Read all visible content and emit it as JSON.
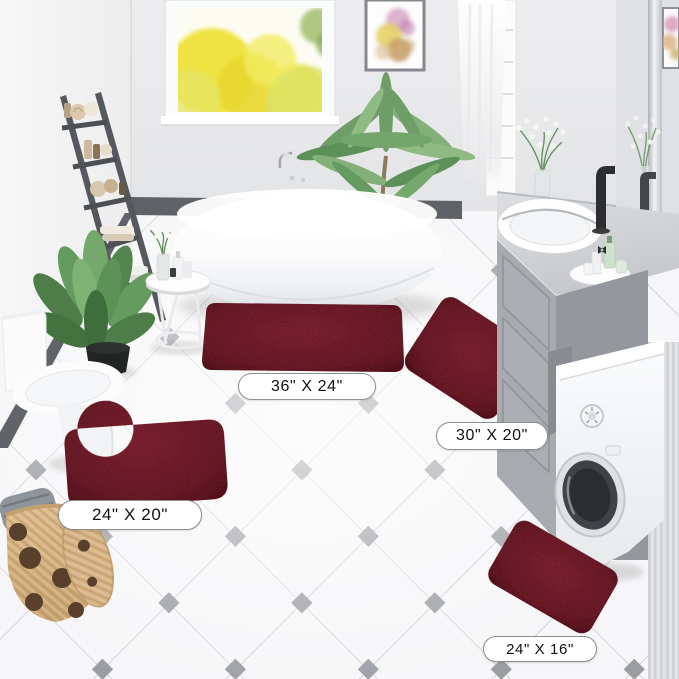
{
  "scene": "bathroom product photo - 4 piece burgundy chenille bath rug set",
  "rug_labels": [
    {
      "name": "rectangle-large",
      "text": "36\" X 24\""
    },
    {
      "name": "rectangle-medium",
      "text": "30\" X 20\""
    },
    {
      "name": "contour",
      "text": "24\" X 20\""
    },
    {
      "name": "rectangle-small",
      "text": "24\" X 16\""
    }
  ],
  "colors": {
    "rug": "#74202e",
    "rug_highlight": "#8a2838",
    "rug_shadow": "#5a1622",
    "label_bg": "#ffffff",
    "label_border": "#8e8e8e",
    "label_text": "#111111"
  },
  "objects": [
    "window-with-yellow-trees",
    "framed-flower-art",
    "sheer-curtain",
    "ladder-shelf-with-towels",
    "freestanding-bathtub",
    "chrome-tub-faucet",
    "palm-plant",
    "leafy-floor-plant",
    "side-table-with-toiletries",
    "toilet",
    "wicker-basket-with-towels",
    "vanity-cabinet",
    "sink-basin",
    "black-faucet",
    "wall-mirror",
    "flower-vase",
    "toiletry-tray",
    "washing-machine",
    "diamond-accent-tile-floor",
    "burgundy-bath-rugs"
  ]
}
